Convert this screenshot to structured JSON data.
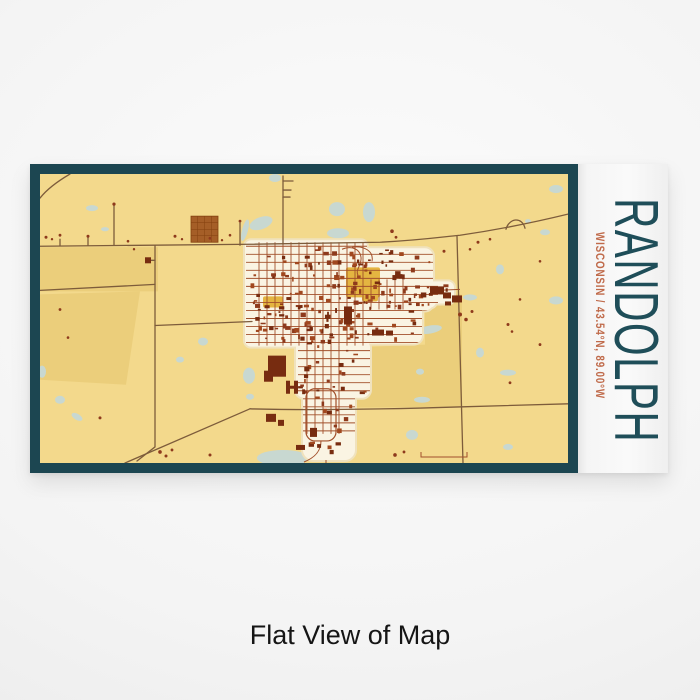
{
  "product": {
    "city": "RANDOLPH",
    "coords_line": "WISCONSIN / 43.54°N, 89.00°W"
  },
  "caption": "Flat View of Map",
  "colors": {
    "frame": "#1c4651",
    "map_bg": "#f3d98c",
    "field": "#ebce7b",
    "pond": "#c8d8d1",
    "road_rural": "#7d5c3b",
    "road_town": "#a2502b",
    "town_bg": "#faf4e3",
    "town_edge": "#f0e2bd",
    "building": "#8e3a1c",
    "building_alt": "#a1481f",
    "building_dark": "#772c10",
    "mustard": "#e4b541",
    "square": "#a55e27",
    "square_line": "#83400f",
    "city_text": "#1f4e59",
    "coords_text": "#c06b4b",
    "caption_text": "#151515"
  },
  "map": {
    "patches": [
      "40,248 158,248 158,292 40,292",
      "40,295 140,292 126,385 40,380",
      "300,350 425,345 425,295 462,295 462,407 300,408"
    ],
    "ponds": [
      [
        57,
        172,
        6,
        3,
        0
      ],
      [
        92,
        209,
        6,
        3,
        0
      ],
      [
        275,
        179,
        6,
        4,
        0
      ],
      [
        261,
        224,
        12,
        6,
        -20
      ],
      [
        337,
        210,
        8,
        7,
        0
      ],
      [
        338,
        234,
        11,
        5,
        0
      ],
      [
        369,
        213,
        6,
        10,
        0
      ],
      [
        556,
        190,
        7,
        4,
        0
      ],
      [
        500,
        270,
        4,
        5,
        0
      ],
      [
        470,
        298,
        7,
        3,
        0
      ],
      [
        556,
        301,
        7,
        4,
        0
      ],
      [
        42,
        372,
        4,
        6,
        0
      ],
      [
        60,
        400,
        5,
        4,
        0
      ],
      [
        77,
        417,
        6,
        3,
        30
      ],
      [
        203,
        342,
        5,
        4,
        0
      ],
      [
        180,
        360,
        4,
        3,
        0
      ],
      [
        249,
        376,
        6,
        8,
        0
      ],
      [
        250,
        397,
        4,
        3,
        0
      ],
      [
        430,
        330,
        12,
        4,
        -10
      ],
      [
        480,
        353,
        4,
        5,
        0
      ],
      [
        508,
        373,
        8,
        3,
        0
      ],
      [
        420,
        372,
        4,
        3,
        0
      ],
      [
        422,
        400,
        8,
        3,
        0
      ],
      [
        412,
        435,
        6,
        5,
        0
      ],
      [
        508,
        447,
        5,
        3,
        0
      ],
      [
        283,
        458,
        26,
        8,
        0
      ],
      [
        545,
        233,
        5,
        3,
        0
      ],
      [
        105,
        230,
        4,
        2,
        0
      ],
      [
        528,
        222,
        3,
        2,
        0
      ],
      [
        245,
        231,
        3,
        11,
        15
      ],
      [
        312,
        430,
        5,
        6,
        0
      ]
    ],
    "blob": [
      [
        245,
        241,
        122,
        106,
        6
      ],
      [
        281,
        249,
        152,
        62,
        8
      ],
      [
        252,
        300,
        170,
        44,
        8
      ],
      [
        296,
        340,
        74,
        58,
        8
      ],
      [
        303,
        383,
        52,
        77,
        10
      ],
      [
        352,
        282,
        84,
        26,
        6
      ],
      [
        360,
        252,
        48,
        38,
        8
      ],
      [
        424,
        282,
        30,
        22,
        6
      ]
    ],
    "mustard": [
      [
        346,
        268,
        34,
        30
      ],
      [
        362,
        292,
        16,
        10
      ],
      [
        263,
        297,
        20,
        11
      ]
    ],
    "gridV": [
      {
        "x0": 259,
        "x1": 363,
        "step": 8,
        "y0": 243,
        "y1": 346
      },
      {
        "x0": 371,
        "x1": 403,
        "step": 8,
        "y0": 280,
        "y1": 310
      },
      {
        "x0": 307,
        "x1": 339,
        "step": 8,
        "y0": 346,
        "y1": 434
      }
    ],
    "gridH": [
      {
        "y0": 247,
        "y1": 343,
        "step": 8,
        "x0": 246,
        "x1": 438
      },
      {
        "y0": 351,
        "y1": 431,
        "step": 8,
        "x0": 298,
        "x1": 372
      }
    ],
    "roads": [
      "M40,247 L250,245 L380,243 C420,241 440,238 460,236 C495,231 535,223 568,215",
      "M283,177 L283,245",
      "M155,246 L155,447 L137,461",
      "M40,291 C80,289 120,287 155,285",
      "M155,326 L252,322",
      "M457,237 L463,463",
      "M250,409 C320,411 400,409 463,407 L568,404",
      "M125,463 L250,409",
      "M70,175 C58,182 47,190 40,199",
      "M114,246 L114,206",
      "M240,246 L240,224",
      "M283,182 L293,182",
      "M283,191 L291,191",
      "M283,198 L290,198",
      "M506,230 C509,219 522,217 525,229",
      "M151,261 L155,261",
      "M88,246 L88,238",
      "M60,246 L60,240"
    ],
    "townRoads": [
      "M321,441 C321,452 314,458 304,462",
      "M342,250 C352,246 360,250 361,258 C362,266 355,270 358,276",
      "M352,248 C364,246 374,252 372,262",
      "M421,452 L421,457 L467,457 L467,452",
      "M436,291 L460,290",
      "M326,460 L326,463"
    ],
    "loop": {
      "x": 306,
      "y": 389,
      "w": 30,
      "h": 52,
      "rx": 9
    },
    "square": {
      "x": 191,
      "y": 217,
      "w": 27,
      "h": 26
    },
    "features": [
      [
        268,
        356,
        18,
        21
      ],
      [
        264,
        371,
        9,
        11
      ],
      [
        344,
        307,
        8,
        18
      ],
      [
        286,
        381,
        4,
        13
      ],
      [
        294,
        381,
        4,
        13
      ],
      [
        287,
        386,
        10,
        3
      ],
      [
        443,
        293,
        8,
        6
      ],
      [
        452,
        296,
        10,
        7
      ],
      [
        445,
        302,
        6,
        4
      ],
      [
        372,
        330,
        12,
        6
      ],
      [
        386,
        331,
        7,
        5
      ],
      [
        430,
        287,
        14,
        8
      ],
      [
        145,
        258,
        6,
        6
      ],
      [
        266,
        414,
        10,
        8
      ],
      [
        278,
        420,
        6,
        6
      ],
      [
        296,
        445,
        9,
        5
      ],
      [
        310,
        428,
        7,
        9
      ]
    ],
    "buildings": {
      "seed": 42,
      "areas": [
        [
          248,
          247,
          118,
          98,
          70
        ],
        [
          283,
          250,
          148,
          58,
          40
        ],
        [
          255,
          302,
          165,
          42,
          48
        ],
        [
          298,
          342,
          70,
          55,
          22
        ],
        [
          305,
          385,
          48,
          70,
          16
        ],
        [
          352,
          285,
          80,
          22,
          14
        ],
        [
          362,
          254,
          44,
          34,
          12
        ],
        [
          426,
          284,
          26,
          18,
          6
        ]
      ]
    },
    "scatter": [
      [
        46,
        238,
        1.5
      ],
      [
        52,
        240,
        1.2
      ],
      [
        60,
        236,
        1.4
      ],
      [
        88,
        237,
        1.5
      ],
      [
        128,
        242,
        1.3
      ],
      [
        134,
        250,
        1.2
      ],
      [
        175,
        237,
        1.5
      ],
      [
        182,
        240,
        1.2
      ],
      [
        210,
        239,
        1.4
      ],
      [
        222,
        241,
        1.2
      ],
      [
        230,
        236,
        1.3
      ],
      [
        114,
        205,
        1.6
      ],
      [
        240,
        222,
        1.4
      ],
      [
        478,
        243,
        1.5
      ],
      [
        490,
        240,
        1.3
      ],
      [
        392,
        232,
        1.8
      ],
      [
        396,
        238,
        1.4
      ],
      [
        444,
        252,
        1.5
      ],
      [
        470,
        250,
        1.3
      ],
      [
        160,
        452,
        1.8
      ],
      [
        166,
        456,
        1.5
      ],
      [
        172,
        450,
        1.4
      ],
      [
        508,
        325,
        1.5
      ],
      [
        512,
        332,
        1.3
      ],
      [
        460,
        315,
        2
      ],
      [
        466,
        320,
        1.8
      ],
      [
        472,
        312,
        1.5
      ],
      [
        510,
        383,
        1.4
      ],
      [
        540,
        262,
        1.3
      ],
      [
        100,
        418,
        1.5
      ],
      [
        210,
        455,
        1.5
      ],
      [
        395,
        455,
        1.8
      ],
      [
        404,
        452,
        1.4
      ],
      [
        540,
        345,
        1.4
      ],
      [
        520,
        300,
        1.3
      ],
      [
        60,
        310,
        1.4
      ],
      [
        68,
        338,
        1.3
      ]
    ]
  }
}
